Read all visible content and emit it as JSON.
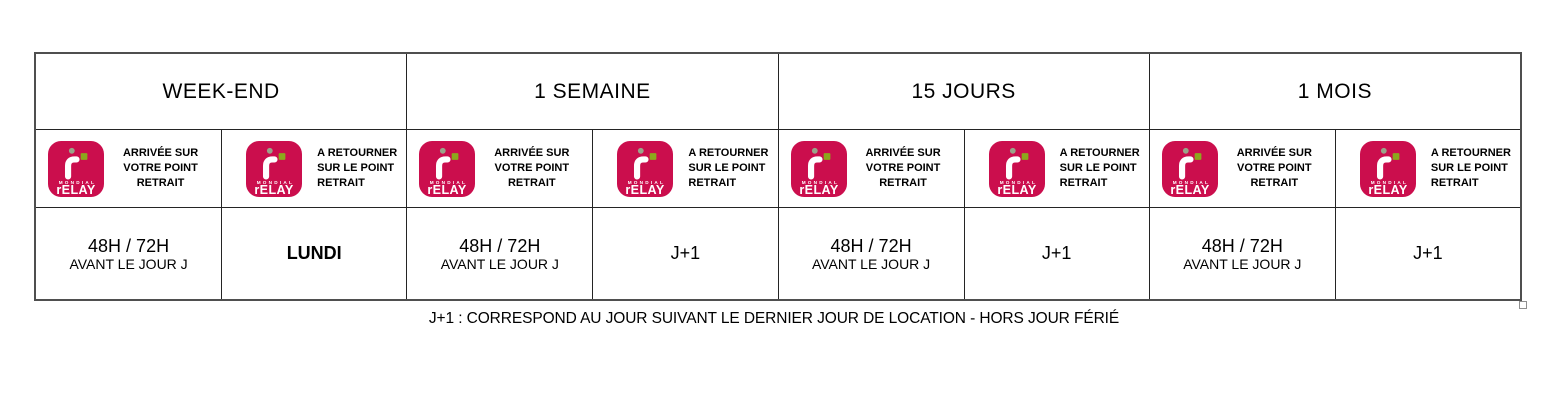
{
  "page": {
    "caption": "J+1 : CORRESPOND AU JOUR SUIVANT LE DERNIER JOUR DE LOCATION - HORS JOUR FÉRIÉ"
  },
  "logo": {
    "brand": "Mondial Relay",
    "mondial": "MONDIAL",
    "relay_r": "r",
    "relay_rest": "ELAY",
    "bg_color": "#CB0E4D",
    "square_color": "#8CA81D",
    "dot_color": "#9AA489"
  },
  "labels": {
    "arrival": [
      "ARRIVÉE SUR",
      "VOTRE POINT RETRAIT"
    ],
    "return": [
      "A RETOURNER",
      "SUR LE POINT",
      "RETRAIT"
    ]
  },
  "table": {
    "columns": [
      {
        "header": "WEEK-END",
        "arrival_value_line1": "48H / 72H",
        "arrival_value_line2": "AVANT LE JOUR J",
        "return_value": "LUNDI"
      },
      {
        "header": "1 SEMAINE",
        "arrival_value_line1": "48H / 72H",
        "arrival_value_line2": "AVANT LE JOUR J",
        "return_value": "J+1"
      },
      {
        "header": "15 JOURS",
        "arrival_value_line1": "48H / 72H",
        "arrival_value_line2": "AVANT LE JOUR J",
        "return_value": "J+1"
      },
      {
        "header": "1 MOIS",
        "arrival_value_line1": "48H / 72H",
        "arrival_value_line2": "AVANT LE JOUR J",
        "return_value": "J+1"
      }
    ]
  }
}
